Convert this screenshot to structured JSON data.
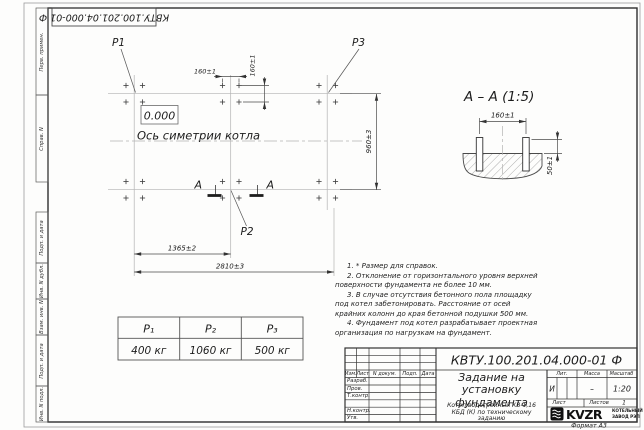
{
  "frame": {
    "top_designation": "КВТУ.100.201.04.000-01 Ф",
    "left_fields": [
      "Перв. примен.",
      "Справ. N",
      "Подп. и дата",
      "Инв. N дубл.",
      "Взам. инв. N",
      "Подп. и дата",
      "Инв. N подл."
    ],
    "format_label": "Формат А3"
  },
  "plan": {
    "p1": "P1",
    "p2": "P2",
    "p3": "P3",
    "elevation": "0.000",
    "axis_label": "Ось симетрии котла",
    "section_letter_left": "А",
    "section_letter_right": "А",
    "dim_width_total": "2810±3",
    "dim_width_half": "1365±2",
    "dim_height": "960±3",
    "dim_bolt_x": "160±1",
    "dim_bolt_y": "160±1"
  },
  "section_view": {
    "title": "А – А (1:5)",
    "dim_width": "160±1",
    "dim_height": "50±1"
  },
  "loads_table": {
    "headers": [
      "P₁",
      "P₂",
      "P₃"
    ],
    "values": [
      "400 кг",
      "1060 кг",
      "500 кг"
    ]
  },
  "notes": [
    "1. * Размер для справок.",
    "2. Отклонение от горизонтального уровня верхней поверхности фундамента не более 10 мм.",
    "3. В случае отсутствия бетонного пола площадку под котел забетонировать. Расстояние от осей крайних колонн до края бетонной подушки 500 мм.",
    "4. Фундамент под котел разрабатывает проектная организация по нагрузкам на фундамент."
  ],
  "title_block": {
    "designation": "КВТУ.100.201.04.000-01 Ф",
    "doc_title": "Задание на установку фундамента",
    "subject": "Котел водогрейный КВ-1,16 КБД (К) по техническому заданию",
    "header_cols": [
      "Изм.",
      "Лист",
      "N докум.",
      "Подп.",
      "Дата"
    ],
    "row_labels": [
      "Разраб.",
      "Пров.",
      "Т.контр.",
      "Н.контр.",
      "Утв."
    ],
    "lit_label": "Лит.",
    "mass_label": "Масса",
    "scale_label": "Масштаб",
    "lit_value": "И",
    "mass_value": "–",
    "scale_value": "1:20",
    "sheet_label": "Лист",
    "sheets_label": "Листов",
    "sheets_value": "1",
    "logo_text": "KVZR",
    "logo_sub_line1": "КОТЕЛЬНЫЙ",
    "logo_sub_line2": "ЗАВОД РЭП"
  }
}
